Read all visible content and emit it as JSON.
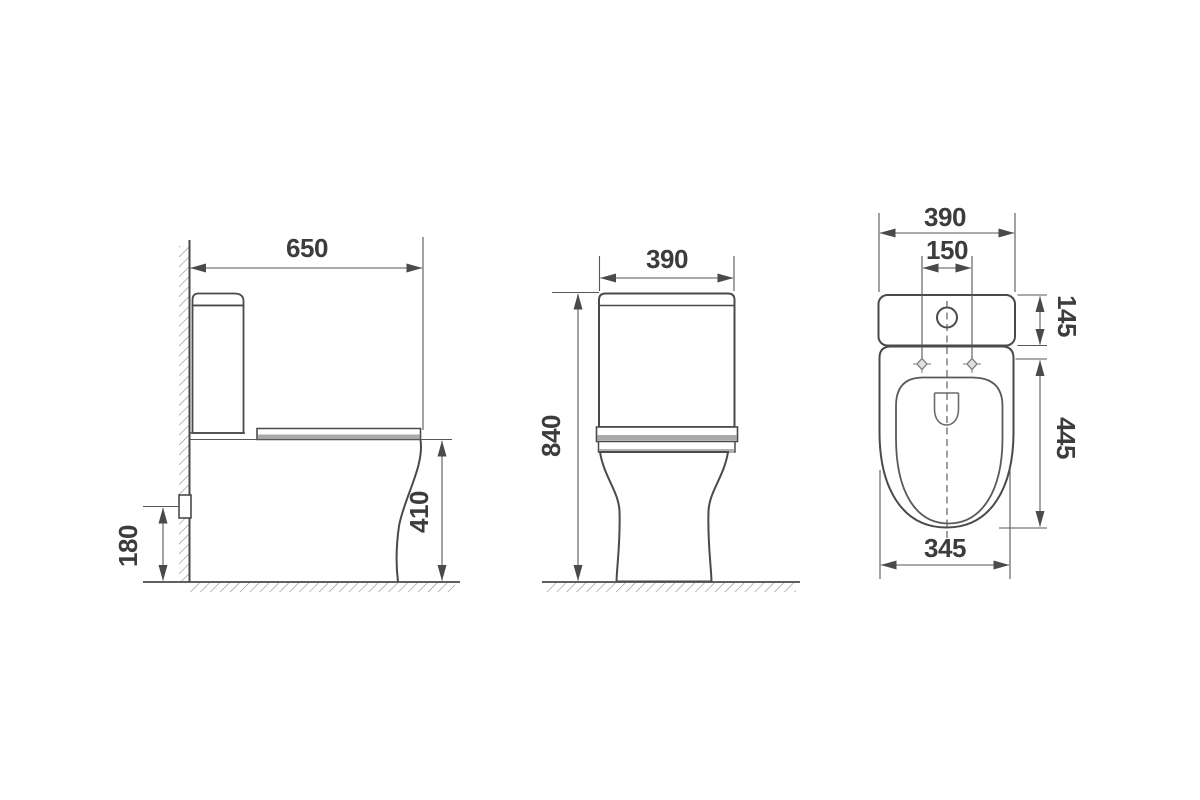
{
  "drawing": {
    "dims": {
      "side_depth": "650",
      "side_bowl_height": "410",
      "side_outlet_height": "180",
      "front_width": "390",
      "front_height": "840",
      "top_width": "390",
      "top_fixing_span": "150",
      "top_cistern_depth": "145",
      "top_seat_length": "445",
      "top_bowl_width": "345"
    },
    "colors": {
      "outline": "#4a4a4a",
      "dimension_line": "#565656",
      "text": "#3c3c3c",
      "shade_gray": "#a9a9a9",
      "hatch_gray": "#8f8f8f",
      "background": "#ffffff"
    }
  }
}
